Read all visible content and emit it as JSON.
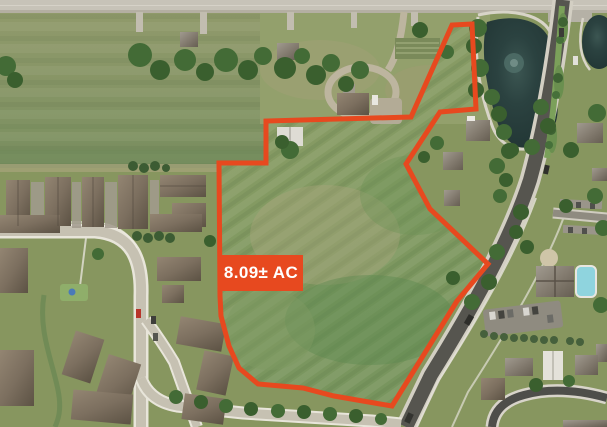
{
  "parcel": {
    "area_label": "8.09± AC",
    "accent_color": "#E7491F",
    "label_text_color": "#FFFFFF",
    "label_box": {
      "x": 219,
      "y": 255,
      "w": 84,
      "h": 36
    },
    "boundary_points": [
      [
        219,
        163
      ],
      [
        266,
        163
      ],
      [
        266,
        121
      ],
      [
        411,
        117
      ],
      [
        452,
        25
      ],
      [
        472,
        24
      ],
      [
        476,
        109
      ],
      [
        440,
        112
      ],
      [
        406,
        164
      ],
      [
        430,
        209
      ],
      [
        488,
        264
      ],
      [
        457,
        301
      ],
      [
        392,
        406
      ],
      [
        334,
        396
      ],
      [
        303,
        388
      ],
      [
        258,
        384
      ],
      [
        239,
        368
      ],
      [
        229,
        346
      ],
      [
        221,
        316
      ],
      [
        220,
        296
      ]
    ]
  }
}
